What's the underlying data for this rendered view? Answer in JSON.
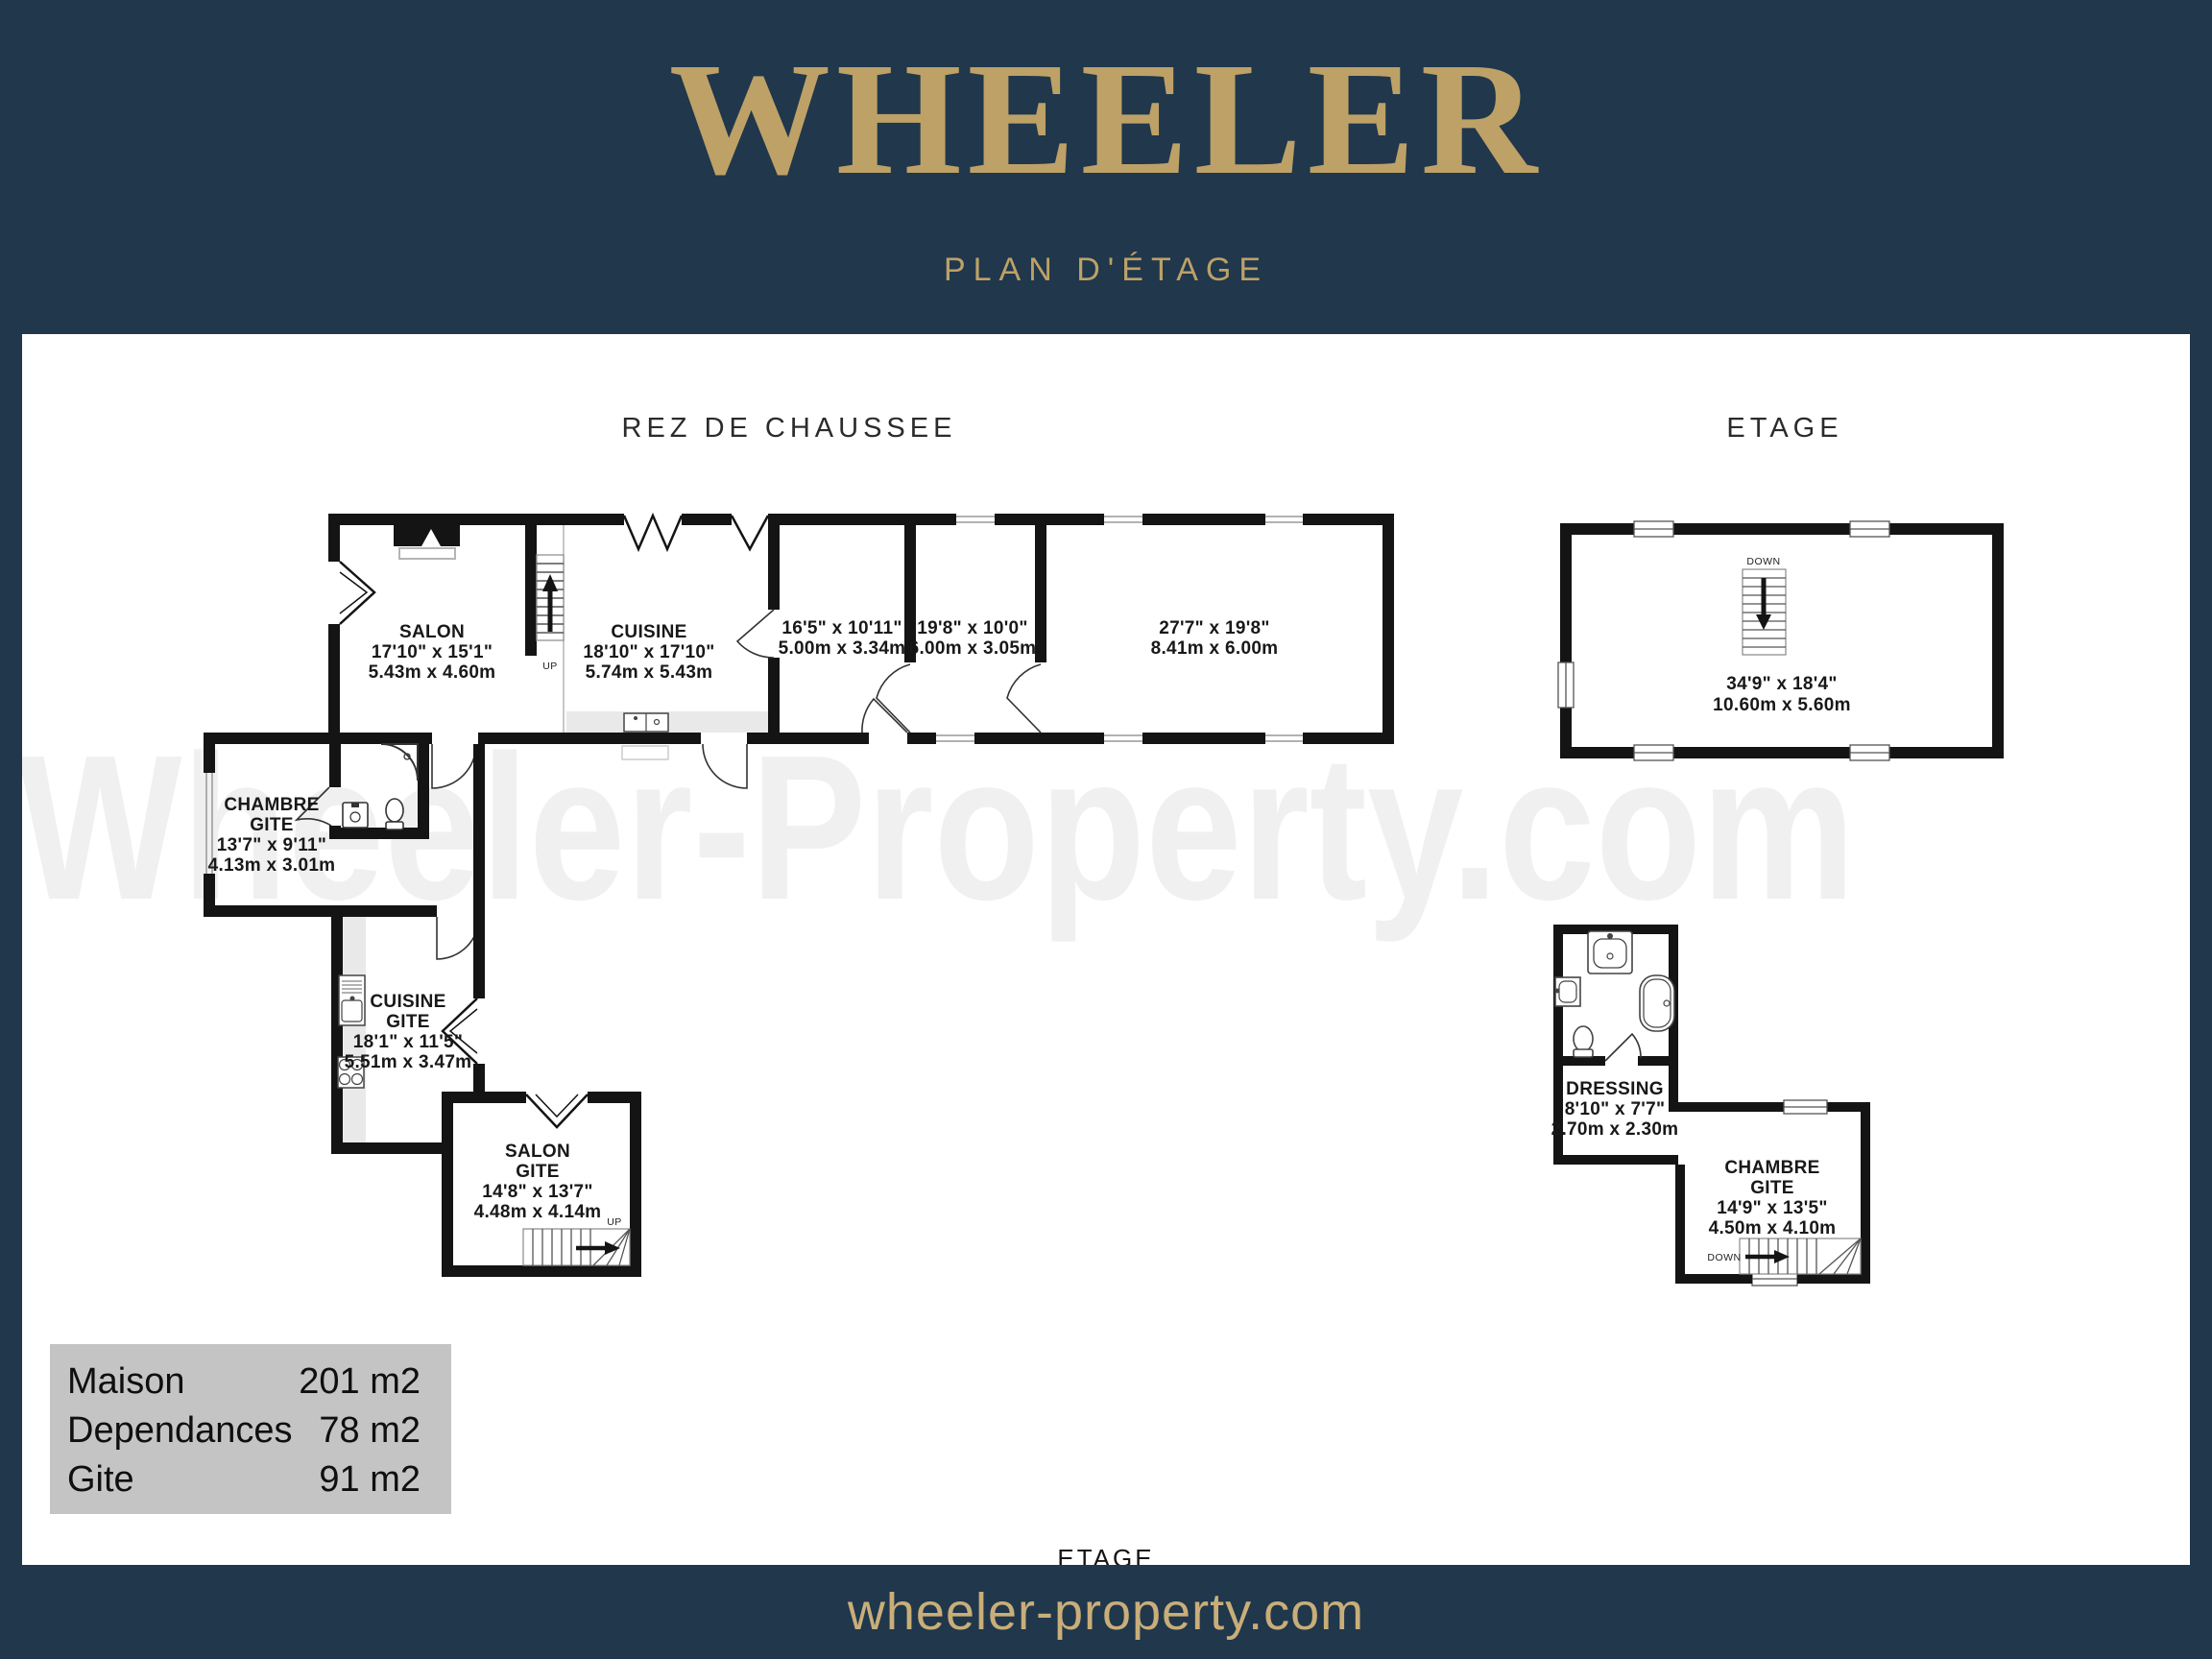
{
  "header": {
    "brand": "WHEELER",
    "subtitle": "PLAN D'ÉTAGE"
  },
  "watermark": "Wheeler-Property.com",
  "plan": {
    "floor_labels": {
      "ground": "REZ DE CHAUSSEE",
      "upper": "ETAGE",
      "upper_small": "ETAGE"
    },
    "stairs": {
      "up": "UP",
      "down": "DOWN"
    },
    "rooms": {
      "salon": {
        "n1": "SALON",
        "imp": "17'10\"  x 15'1\"",
        "met": "5.43m  x 4.60m"
      },
      "cuisine": {
        "n1": "CUISINE",
        "imp": "18'10\"  x 17'10\"",
        "met": "5.74m  x 5.43m"
      },
      "room_16_5": {
        "imp": "16'5\"  x 10'11\"",
        "met": "5.00m  x 3.34m"
      },
      "room_19_8": {
        "imp": "19'8\"  x 10'0\"",
        "met": "6.00m  x 3.05m"
      },
      "room_27_7": {
        "imp": "27'7\"  x 19'8\"",
        "met": "8.41m  x 6.00m"
      },
      "chambre_gite_rdc": {
        "n1": "CHAMBRE",
        "n2": "GITE",
        "imp": "13'7\"  x 9'11\"",
        "met": "4.13m  x 3.01m"
      },
      "cuisine_gite": {
        "n1": "CUISINE",
        "n2": "GITE",
        "imp": "18'1\"  x 11'5\"",
        "met": "5.51m  x 3.47m"
      },
      "salon_gite": {
        "n1": "SALON",
        "n2": "GITE",
        "imp": "14'8\"  x 13'7\"",
        "met": "4.48m  x 4.14m"
      },
      "etage_main": {
        "imp": "34'9\"  x 18'4\"",
        "met": "10.60m  x 5.60m"
      },
      "dressing": {
        "n1": "DRESSING",
        "imp": "8'10\"  x 7'7\"",
        "met": "2.70m  x 2.30m"
      },
      "chambre_gite_etage": {
        "n1": "CHAMBRE",
        "n2": "GITE",
        "imp": "14'9\"  x 13'5\"",
        "met": "4.50m  x 4.10m"
      }
    }
  },
  "legend": {
    "rows": [
      {
        "label": "Maison",
        "value": "201 m2"
      },
      {
        "label": "Dependances",
        "value": "78 m2"
      },
      {
        "label": "Gite",
        "value": "91 m2"
      }
    ]
  },
  "footer": {
    "website": "wheeler-property.com"
  },
  "colors": {
    "navy": "#20374c",
    "gold": "#bda167",
    "legend_gray": "#c5c4c4",
    "wall_black": "#141414",
    "watermark_gray": "#f1f0f1"
  }
}
